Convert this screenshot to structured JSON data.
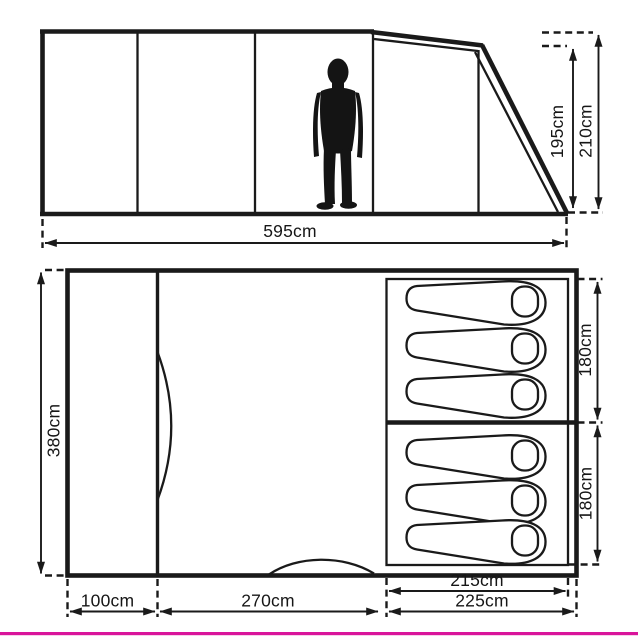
{
  "colors": {
    "ink": "#1a1a1a",
    "accent_bar": "#d9149b",
    "background": "#ffffff"
  },
  "side_view": {
    "total_length": "595cm",
    "eave_height": "195cm",
    "peak_height": "210cm"
  },
  "floor_plan": {
    "total_width": "380cm",
    "bedroom_top_depth": "180cm",
    "bedroom_bottom_depth": "180cm",
    "bedroom_inner_width": "215cm",
    "bedroom_outer_width": "225cm",
    "front_section_width": "100cm",
    "middle_section_width": "270cm",
    "sleeping_bags_top_room": 3,
    "sleeping_bags_bottom_room": 3
  }
}
